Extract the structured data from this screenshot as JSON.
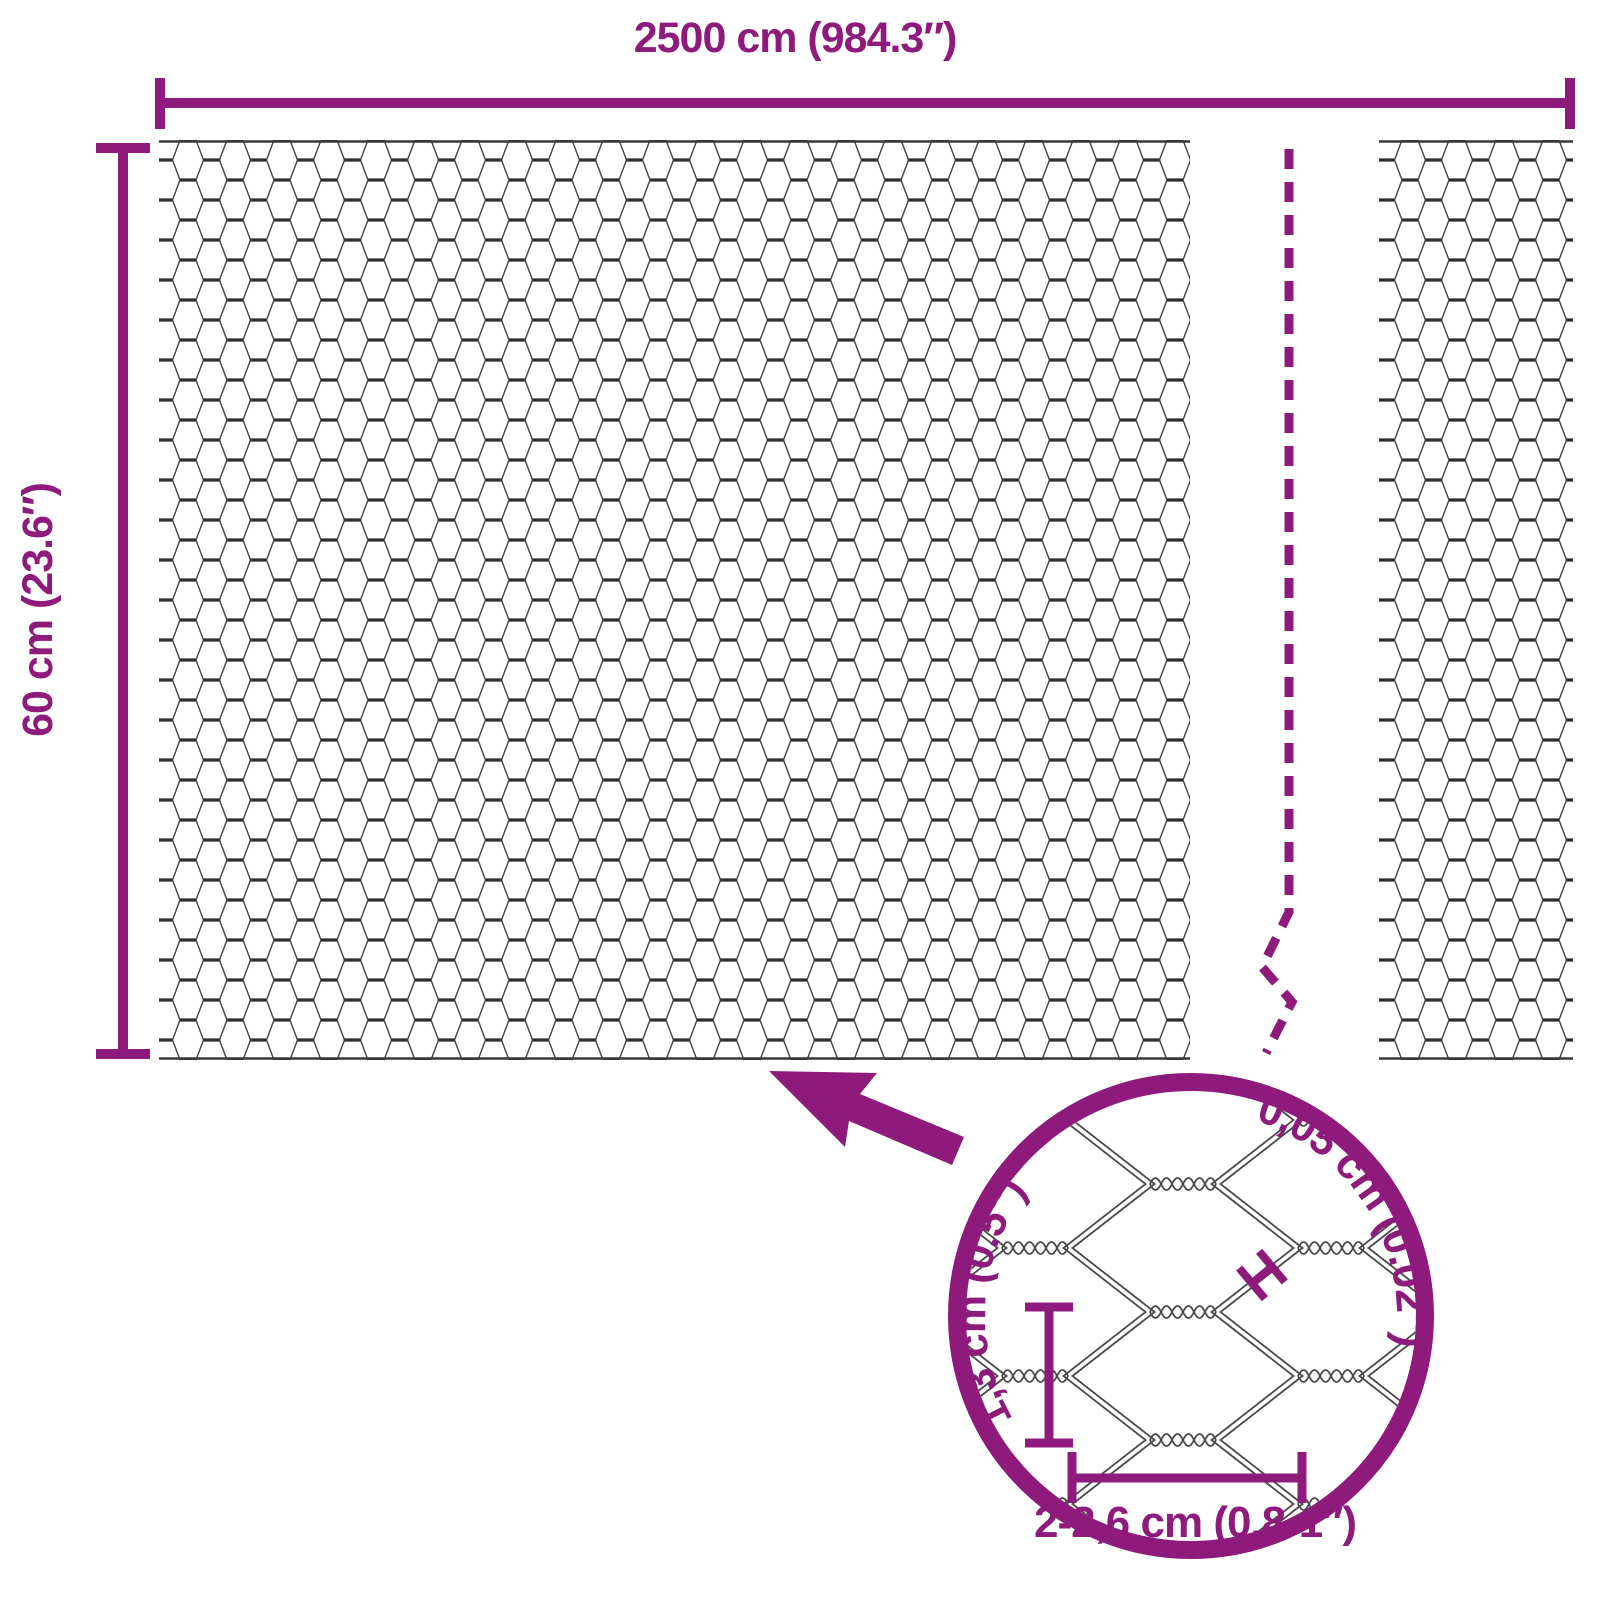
{
  "colors": {
    "accent": "#8E1A7C",
    "mesh_line": "#4A4A4A",
    "mesh_twist": "#2E2E2E",
    "background": "#FFFFFF"
  },
  "labels": {
    "overall_width": "2500 cm (984.3″)",
    "overall_height": "60 cm (23.6″)",
    "wire_thickness": "0,05 cm (0.02″)",
    "cell_height": "1,3 cm (0.5″)",
    "cell_width": "2-2,6 cm (0.8-1″)"
  }
}
